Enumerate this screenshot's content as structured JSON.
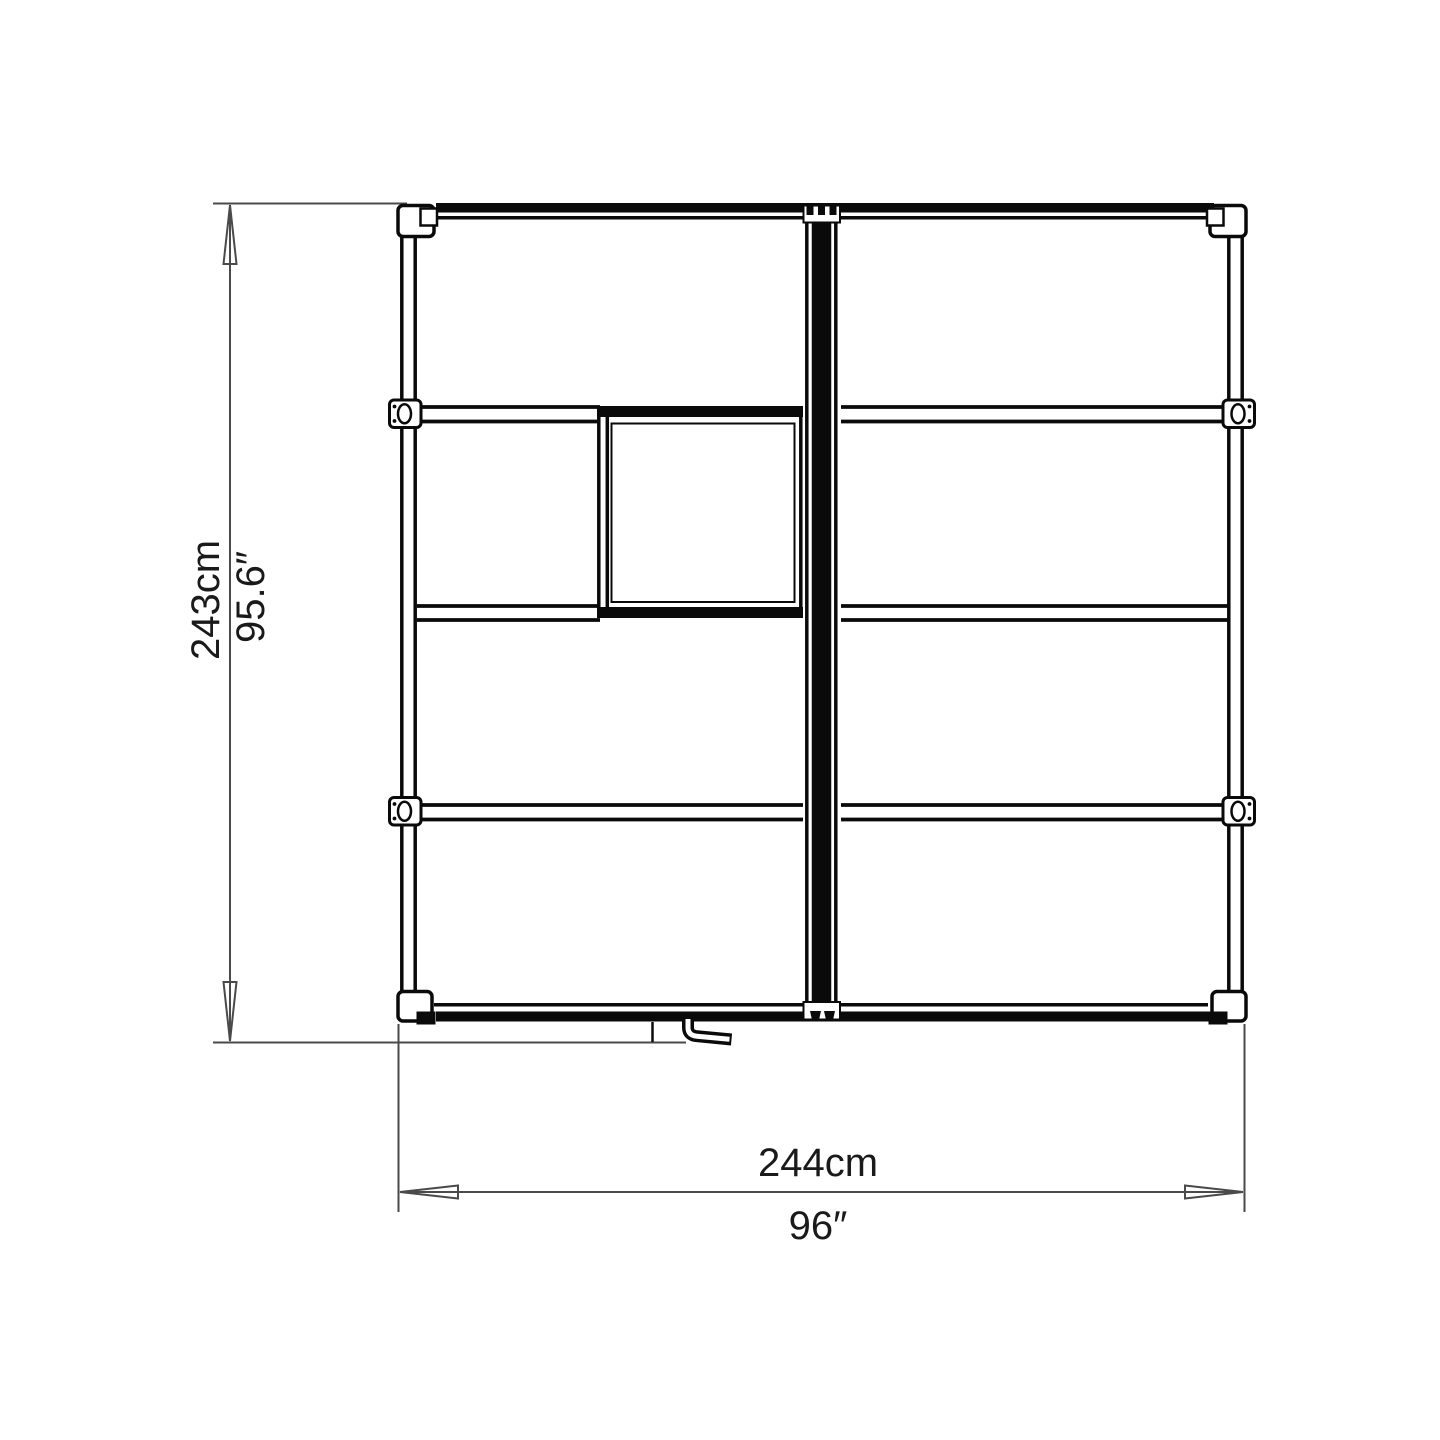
{
  "diagram": {
    "title": "greenhouse-plan-top-view",
    "colors": {
      "line": "#0a0a0a",
      "dimension": "#4a4a4a",
      "text": "#1a1a1a",
      "background": "#ffffff"
    },
    "dimensions": {
      "height_metric": "243cm",
      "height_imperial": "95.6″",
      "width_metric": "244cm",
      "width_imperial": "96″"
    }
  }
}
